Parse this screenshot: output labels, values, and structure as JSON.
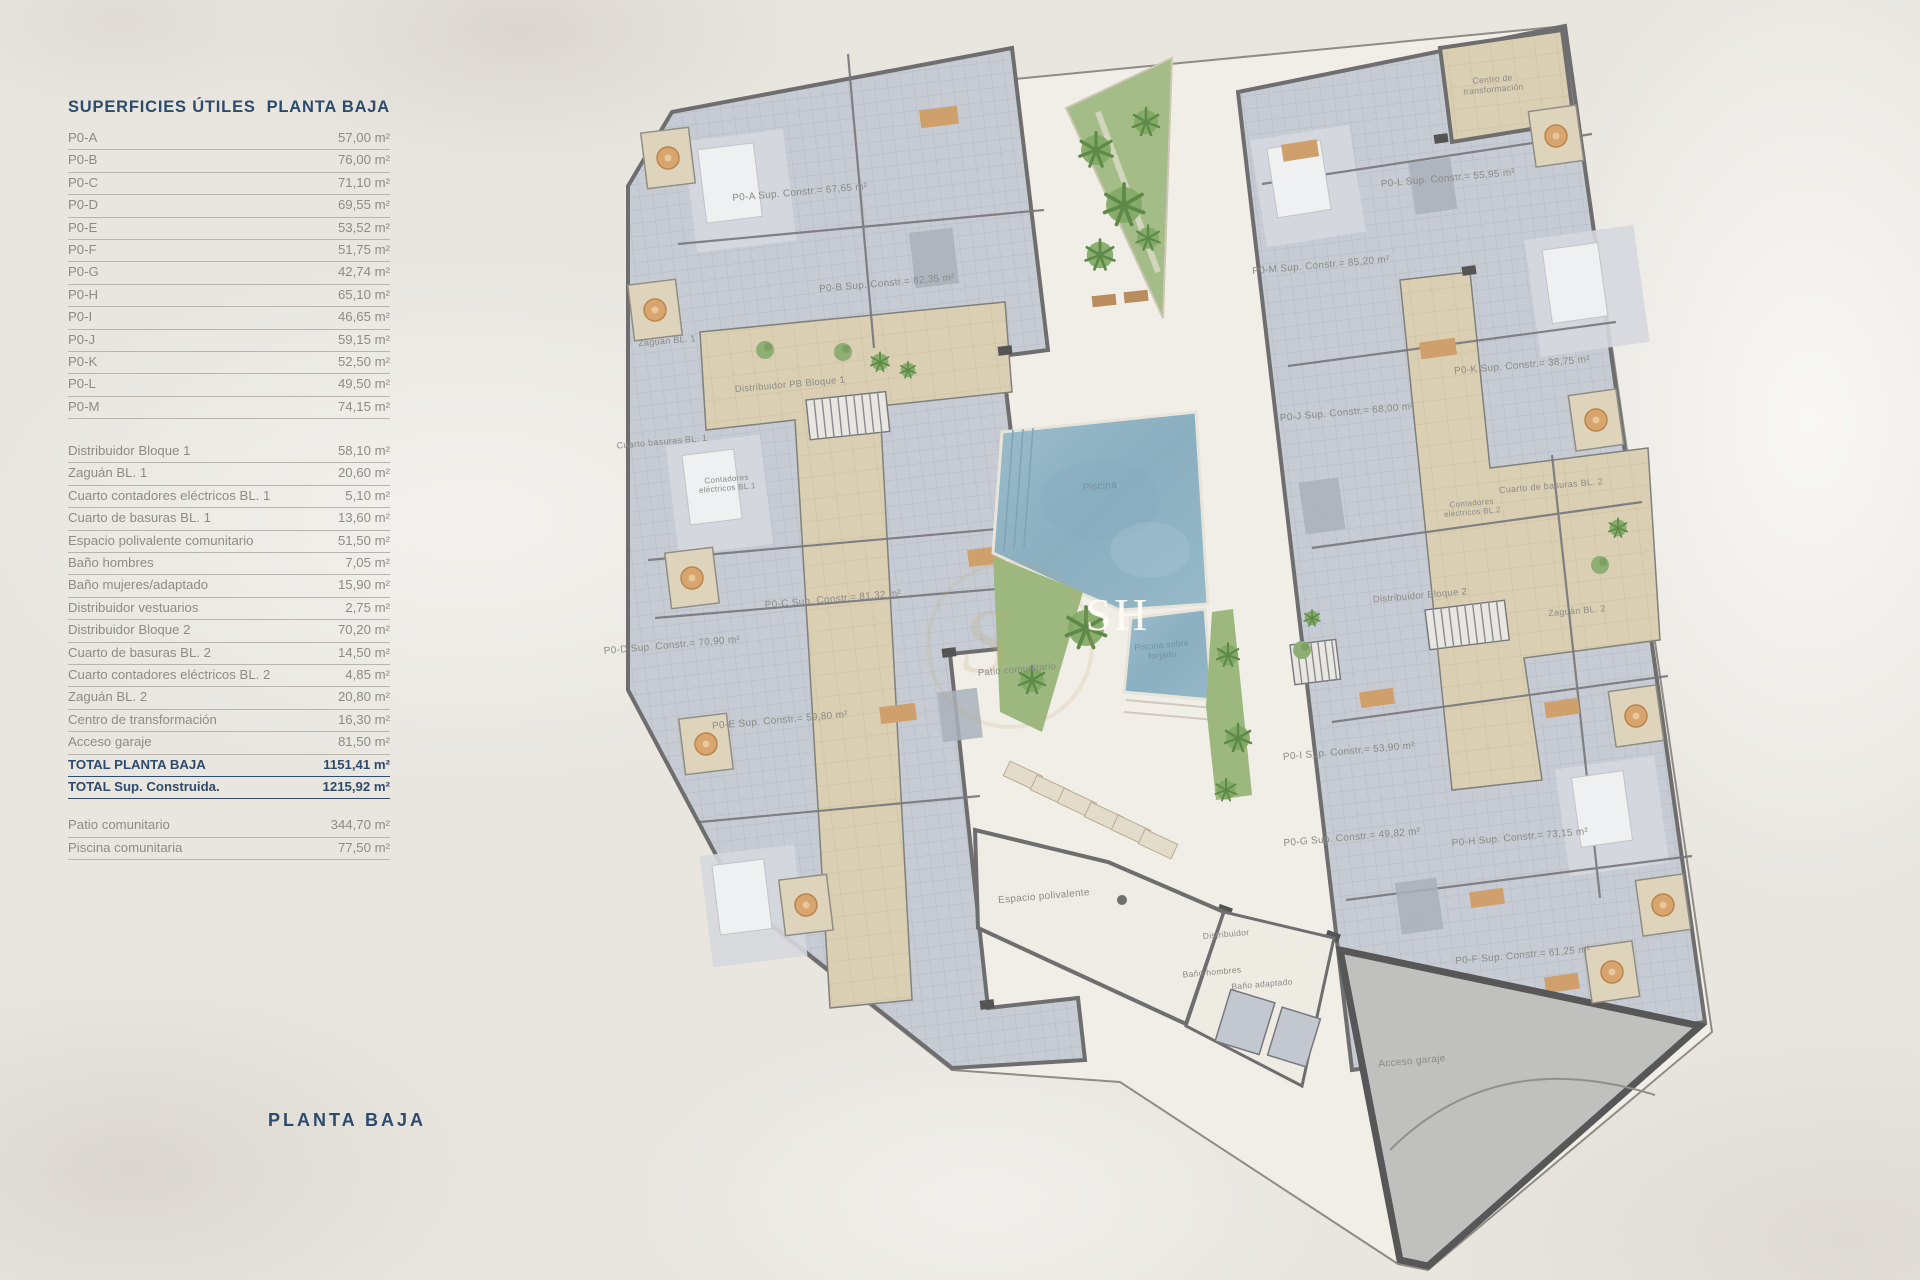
{
  "page": {
    "background": "#e9e6e0",
    "title_bottom": "PLANTA BAJA"
  },
  "colors": {
    "accent_navy": "#2d4b6d",
    "row_text": "#8e8b85",
    "wall_gray": "#6e6e6e",
    "tile_blue_gray": "#c7ccd4",
    "corridor_tan": "#dacfb2",
    "pool_blue": "#8fb3c4",
    "garden_green": "#9db87e"
  },
  "sidebar": {
    "title_left": "SUPERFICIES ÚTILES",
    "title_right": "PLANTA BAJA",
    "apartments": [
      {
        "label": "P0-A",
        "value": "57,00 m²"
      },
      {
        "label": "P0-B",
        "value": "76,00 m²"
      },
      {
        "label": "P0-C",
        "value": "71,10 m²"
      },
      {
        "label": "P0-D",
        "value": "69,55 m²"
      },
      {
        "label": "P0-E",
        "value": "53,52 m²"
      },
      {
        "label": "P0-F",
        "value": "51,75 m²"
      },
      {
        "label": "P0-G",
        "value": "42,74 m²"
      },
      {
        "label": "P0-H",
        "value": "65,10 m²"
      },
      {
        "label": "P0-I",
        "value": "46,65 m²"
      },
      {
        "label": "P0-J",
        "value": "59,15 m²"
      },
      {
        "label": "P0-K",
        "value": "52,50 m²"
      },
      {
        "label": "P0-L",
        "value": "49,50 m²"
      },
      {
        "label": "P0-M",
        "value": "74,15 m²"
      }
    ],
    "common": [
      {
        "label": "Distribuidor Bloque 1",
        "value": "58,10 m²"
      },
      {
        "label": "Zaguán BL. 1",
        "value": "20,60 m²"
      },
      {
        "label": "Cuarto contadores eléctricos BL. 1",
        "value": "5,10 m²"
      },
      {
        "label": "Cuarto de basuras BL. 1",
        "value": "13,60 m²"
      },
      {
        "label": "Espacio polivalente comunitario",
        "value": "51,50 m²"
      },
      {
        "label": "Baño hombres",
        "value": "7,05 m²"
      },
      {
        "label": "Baño mujeres/adaptado",
        "value": "15,90 m²"
      },
      {
        "label": "Distribuidor vestuarios",
        "value": "2,75 m²"
      },
      {
        "label": "Distribuidor Bloque 2",
        "value": "70,20 m²"
      },
      {
        "label": "Cuarto de basuras BL. 2",
        "value": "14,50 m²"
      },
      {
        "label": "Cuarto contadores eléctricos BL. 2",
        "value": "4,85 m²"
      },
      {
        "label": "Zaguán BL. 2",
        "value": "20,80 m²"
      },
      {
        "label": "Centro de transformación",
        "value": "16,30 m²"
      },
      {
        "label": "Acceso garaje",
        "value": "81,50 m²"
      }
    ],
    "totals": [
      {
        "label": "TOTAL PLANTA BAJA",
        "value": "1151,41 m²"
      },
      {
        "label": "TOTAL Sup. Construida.",
        "value": "1215,92 m²"
      }
    ],
    "outdoor": [
      {
        "label": "Patio comunitario",
        "value": "344,70 m²"
      },
      {
        "label": "Piscina comunitaria",
        "value": "77,50 m²"
      }
    ]
  },
  "plan": {
    "watermark": {
      "monogram": "SH",
      "flourish": "S"
    },
    "labels": [
      {
        "text": "P0-A Sup. Constr.= 67,65 m²",
        "x": 800,
        "y": 193
      },
      {
        "text": "P0-B Sup. Constr.= 82,35 m²",
        "x": 887,
        "y": 284
      },
      {
        "text": "P0-C Sup. Constr.= 81,32 m²",
        "x": 833,
        "y": 600
      },
      {
        "text": "P0-D Sup. Constr.= 70,90 m²",
        "x": 672,
        "y": 646
      },
      {
        "text": "P0-E Sup. Constr.= 59,80 m²",
        "x": 780,
        "y": 721
      },
      {
        "text": "P0-F Sup. Constr.= 61,25 m²",
        "x": 1523,
        "y": 956
      },
      {
        "text": "P0-G Sup. Constr.= 49,82 m²",
        "x": 1352,
        "y": 838
      },
      {
        "text": "P0-H Sup. Constr.= 73,15 m²",
        "x": 1520,
        "y": 838
      },
      {
        "text": "P0-I Sup. Constr.= 53,90 m²",
        "x": 1349,
        "y": 752
      },
      {
        "text": "P0-J Sup. Constr.= 68,00 m²",
        "x": 1347,
        "y": 413
      },
      {
        "text": "P0-K Sup. Constr.= 38,75 m²",
        "x": 1522,
        "y": 366
      },
      {
        "text": "P0-L Sup. Constr.= 55,95 m²",
        "x": 1448,
        "y": 179
      },
      {
        "text": "P0-M Sup. Constr.= 85,20 m²",
        "x": 1321,
        "y": 266
      },
      {
        "text": "Zaguán BL. 1",
        "x": 667,
        "y": 341,
        "size": 9
      },
      {
        "text": "Distribuidor PB Bloque 1",
        "x": 790,
        "y": 385,
        "size": 9.5
      },
      {
        "text": "Cuarto basuras BL. 1",
        "x": 662,
        "y": 442,
        "size": 9
      },
      {
        "text": "Contadores eléctricos BL.1",
        "x": 727,
        "y": 484,
        "size": 8,
        "w": 70
      },
      {
        "text": "Cuarto de basuras BL. 2",
        "x": 1551,
        "y": 486,
        "size": 9
      },
      {
        "text": "Contadores eléctricos BL.2",
        "x": 1472,
        "y": 508,
        "size": 8,
        "w": 70
      },
      {
        "text": "Distribuidor Bloque 2",
        "x": 1420,
        "y": 596,
        "size": 9.5
      },
      {
        "text": "Zaguán BL. 2",
        "x": 1577,
        "y": 611,
        "size": 9
      },
      {
        "text": "Centro de transformación",
        "x": 1493,
        "y": 84,
        "size": 8.5,
        "w": 86
      },
      {
        "text": "Piscina",
        "x": 1100,
        "y": 487,
        "color": "#72909e"
      },
      {
        "text": "Piscina sobre forjado",
        "x": 1162,
        "y": 650,
        "size": 8.5,
        "w": 72,
        "color": "#72909e"
      },
      {
        "text": "Patio comunitario",
        "x": 1017,
        "y": 670,
        "size": 9.5
      },
      {
        "text": "Espacio polivalente",
        "x": 1044,
        "y": 897
      },
      {
        "text": "Distribuidor",
        "x": 1226,
        "y": 934,
        "size": 8.5
      },
      {
        "text": "Baño hombres",
        "x": 1212,
        "y": 972,
        "size": 8.5
      },
      {
        "text": "Baño adaptado",
        "x": 1262,
        "y": 984,
        "size": 8.5
      },
      {
        "text": "Acceso garaje",
        "x": 1412,
        "y": 1062
      }
    ]
  }
}
